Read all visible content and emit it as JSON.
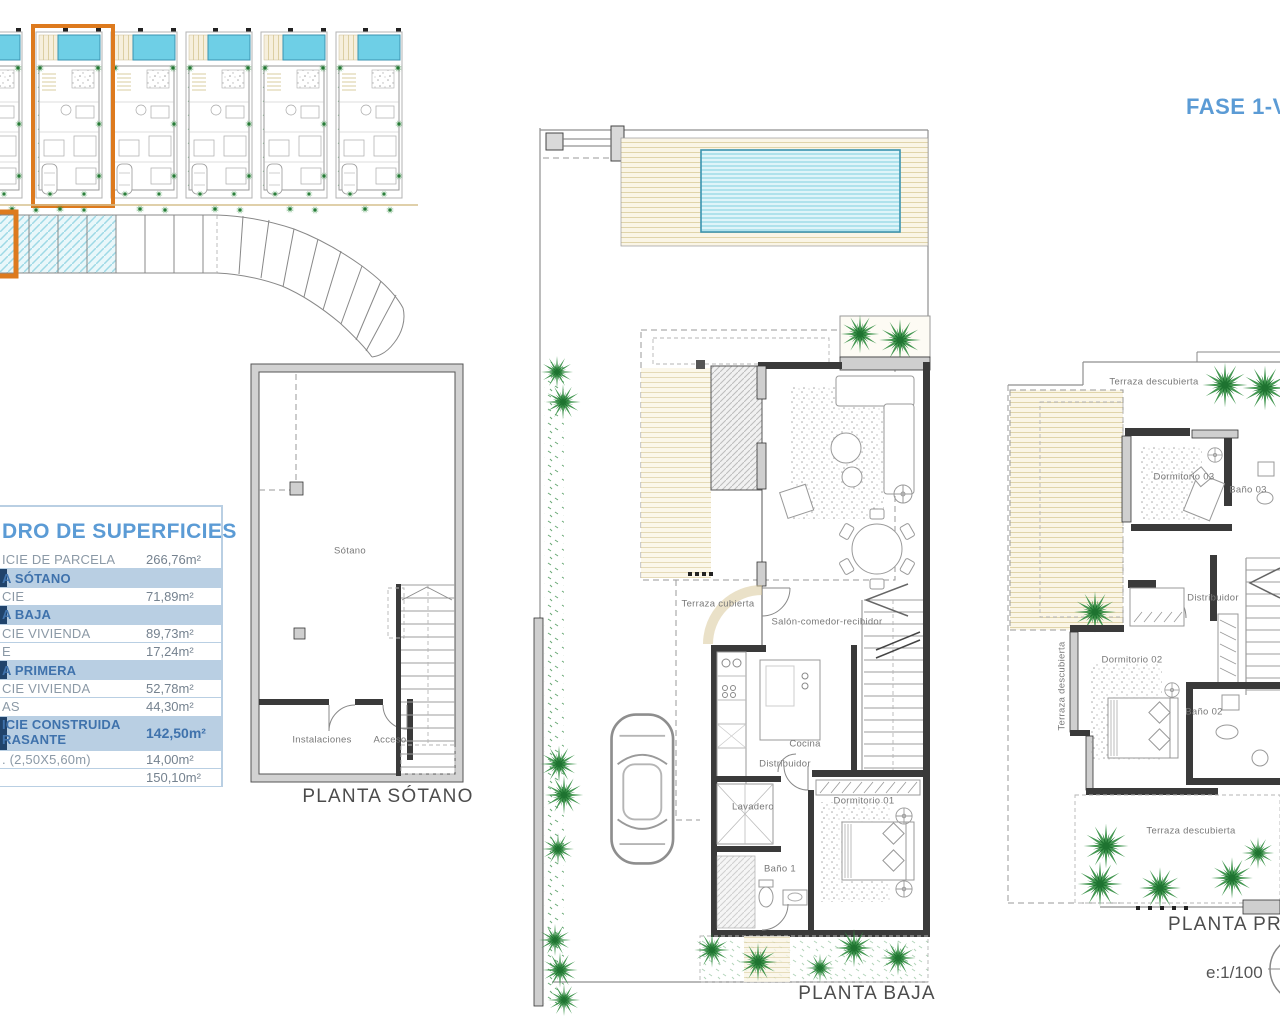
{
  "sheet": {
    "fase_label": "FASE 1-VILL",
    "scale_label": "e:1/100"
  },
  "surface_table": {
    "title": "DRO DE SUPERFICIES",
    "rows": [
      {
        "type": "row",
        "label": "ICIE DE PARCELA",
        "value": "266,76m²"
      },
      {
        "type": "header",
        "label": "A SÓTANO",
        "value": ""
      },
      {
        "type": "row",
        "label": "CIE",
        "value": "71,89m²"
      },
      {
        "type": "header",
        "label": "A BAJA",
        "value": ""
      },
      {
        "type": "row",
        "label": "CIE VIVIENDA",
        "value": "89,73m²"
      },
      {
        "type": "row",
        "label": "E",
        "value": "17,24m²"
      },
      {
        "type": "header",
        "label": "A PRIMERA",
        "value": ""
      },
      {
        "type": "row",
        "label": "CIE VIVIENDA",
        "value": "52,78m²"
      },
      {
        "type": "row",
        "label": "AS",
        "value": "44,30m²"
      },
      {
        "type": "header2",
        "label": "ICIE CONSTRUIDA",
        "label2": "RASANTE",
        "value": "142,50m²"
      },
      {
        "type": "row",
        "label": ". (2,50X5,60m)",
        "value": "14,00m²"
      },
      {
        "type": "row",
        "label": "",
        "value": "150,10m²"
      }
    ]
  },
  "basement": {
    "room_sotano": "Sótano",
    "room_instalaciones": "Instalaciones",
    "room_acceso": "Acceso",
    "caption": "PLANTA SÓTANO"
  },
  "ground_floor": {
    "terraza_cubierta": "Terraza cubierta",
    "salon": "Salón-comedor-recibidor",
    "cocina": "Cocina",
    "distribuidor": "Distribuidor",
    "lavadero": "Lavadero",
    "bano1": "Baño 1",
    "dormitorio1": "Dormitorio 01",
    "caption": "PLANTA BAJA"
  },
  "first_floor": {
    "terraza_top": "Terraza descubierta",
    "terraza_left": "Terraza descubierta",
    "terraza_bottom": "Terraza descubierta",
    "dormitorio3": "Dormitorio 03",
    "bano3": "Baño 03",
    "distribuidor": "Distribuidor",
    "dormitorio2": "Dormitorio 02",
    "bano2": "Baño 02",
    "caption": "PLANTA PRIMERA"
  },
  "colors": {
    "accent_blue": "#5b9bd5",
    "table_band_blue": "#b9cfe3",
    "table_band_navy": "#20436b",
    "highlight_orange": "#dd7a1e",
    "pool_blue": "#6ecfe6",
    "deck_tan": "#e0d4aa",
    "plant_green": "#2e8b3f",
    "wall_dark": "#3a3a3a",
    "wall_gray": "#cfcfcf"
  }
}
